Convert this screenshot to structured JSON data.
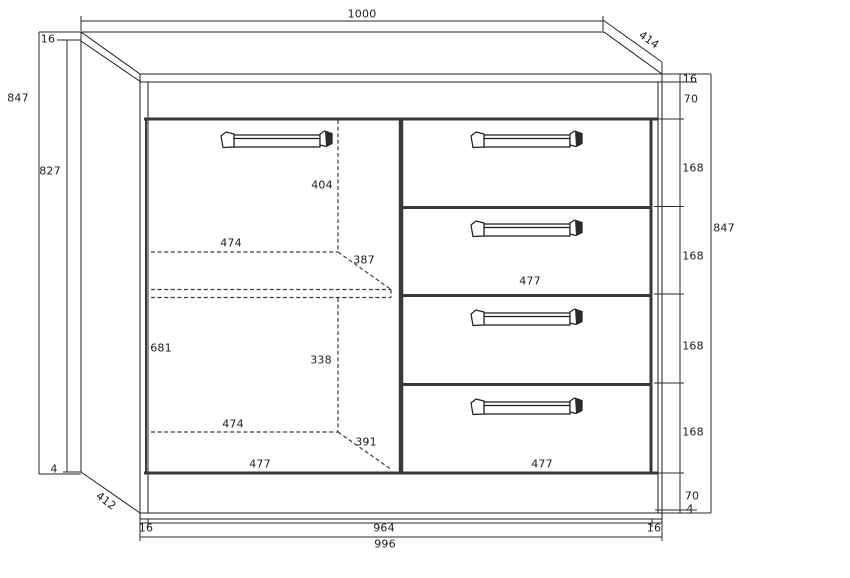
{
  "drawing": {
    "type": "furniture-dimension-diagram",
    "units": "mm",
    "colors": {
      "ink": "#1c1c1c",
      "thick_line": "#3a3a3a",
      "background": "#ffffff"
    }
  },
  "dims": {
    "top_width": "1000",
    "top_depth": "414",
    "top_thickness": "16",
    "height_total_left": "847",
    "side_height": "827",
    "bottom_gap_left": "4",
    "bottom_depth": "412",
    "handle_top_height": "404",
    "inner_width_top": "474",
    "shelf_depth_top": "387",
    "door_height": "681",
    "handle_bottom_height": "338",
    "inner_width_bottom": "474",
    "shelf_depth_bottom": "391",
    "door_width": "477",
    "drawer_width_mid": "477",
    "drawer_width_bottom": "477",
    "right_top_thickness": "16",
    "right_top_rail": "70",
    "right_drawer1": "168",
    "right_drawer2": "168",
    "right_drawer3": "168",
    "right_drawer4": "168",
    "right_bottom_rail": "70",
    "right_bottom_gap": "4",
    "height_total_right": "847",
    "bottom_side_left": "16",
    "bottom_inner_width": "964",
    "bottom_side_right": "16",
    "bottom_outer_width": "996"
  }
}
